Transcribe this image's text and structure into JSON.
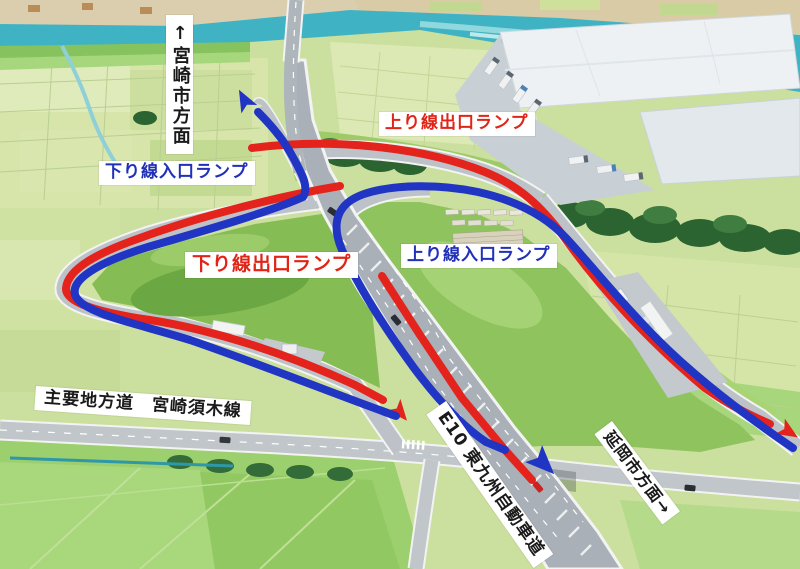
{
  "labels": {
    "miyazaki_direction": "↑宮崎市方面",
    "prefectural_road": "主要地方道　宮崎須木線",
    "expressway_name": "E10 東九州自動車道",
    "nobeoka_direction": "延岡市方面→"
  },
  "ramps": [
    {
      "label": "上り線出口ランプ",
      "kind": "exit"
    },
    {
      "label": "下り線入口ランプ",
      "kind": "entrance"
    },
    {
      "label": "下り線出口ランプ",
      "kind": "exit"
    },
    {
      "label": "上り線入口ランプ",
      "kind": "entrance"
    }
  ],
  "colors": {
    "exit_ramp_route": "#e3231c",
    "entrance_ramp_route": "#2135c4",
    "exit_label_text": "#e02517",
    "entrance_label_text": "#2030b8",
    "road_label_text": "#1a1a1a",
    "label_background": "#ffffff"
  }
}
